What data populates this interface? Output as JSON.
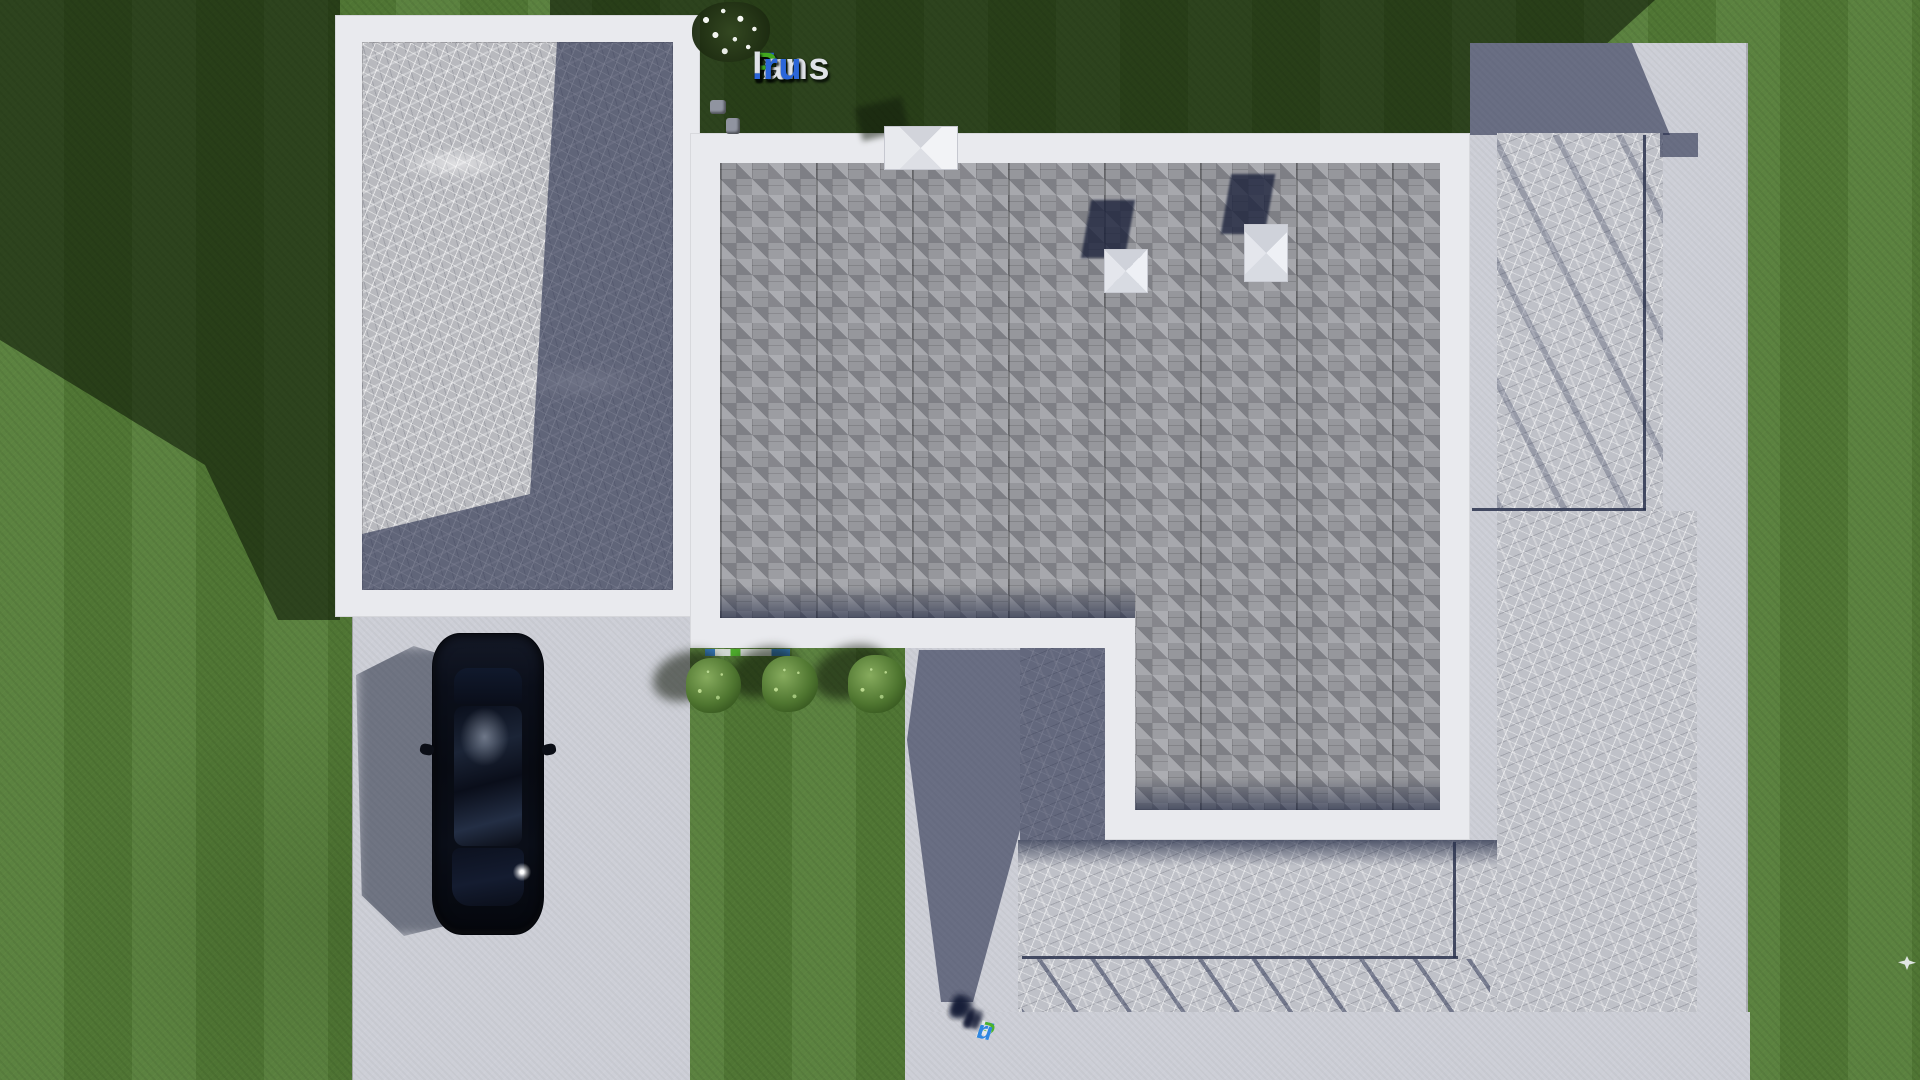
{
  "canvas": {
    "width": 1920,
    "height": 1080
  },
  "watermark": {
    "full_text": "FixPlans.ru",
    "parts": [
      {
        "text": "F",
        "color": "#2b66d9"
      },
      {
        "text": "ix",
        "color": "#dfe2e8"
      },
      {
        "text": "P",
        "color": "#41a81e"
      },
      {
        "text": "lans",
        "color": "#dfe2e8"
      },
      {
        "text": ".ru",
        "color": "#2b66d9"
      }
    ]
  },
  "ground_logo": {
    "full_text": "FixPlans.ru",
    "parts": [
      {
        "text": "F",
        "color": "#2e86e0"
      },
      {
        "text": "i",
        "color": "#6ec13e"
      },
      {
        "text": "x",
        "color": "#e5e7ea"
      },
      {
        "text": "P",
        "color": "#4cb32a"
      },
      {
        "text": "l",
        "color": "#e5e7ea"
      },
      {
        "text": "a",
        "color": "#e5e7ea"
      },
      {
        "text": "n",
        "color": "#e5e7ea"
      },
      {
        "text": "s",
        "color": "#e5e7ea"
      },
      {
        "text": ".",
        "color": "#2e86e0"
      },
      {
        "text": "r",
        "color": "#2e86e0"
      },
      {
        "text": "u",
        "color": "#2e86e0"
      }
    ]
  },
  "palette": {
    "grass_green": "#547c37",
    "grass_shadow": "#223414",
    "concrete_light": "#cdcfd7",
    "stone_gray": "#bfc1c8",
    "marble_gray": "#b8b9be",
    "shingle_gray": "#96979c",
    "parapet_white": "#e9eaee",
    "skylight_white": "#eef0f4",
    "shadow_navy": "#3c4566",
    "car_black": "#0a0d15",
    "logo_blue": "#2b66d9",
    "logo_green": "#41a81e",
    "logo_white": "#dfe2e8"
  },
  "scene": {
    "skylight_count": 2,
    "bush_count": 3,
    "car_count": 1,
    "bird_count": 1
  }
}
